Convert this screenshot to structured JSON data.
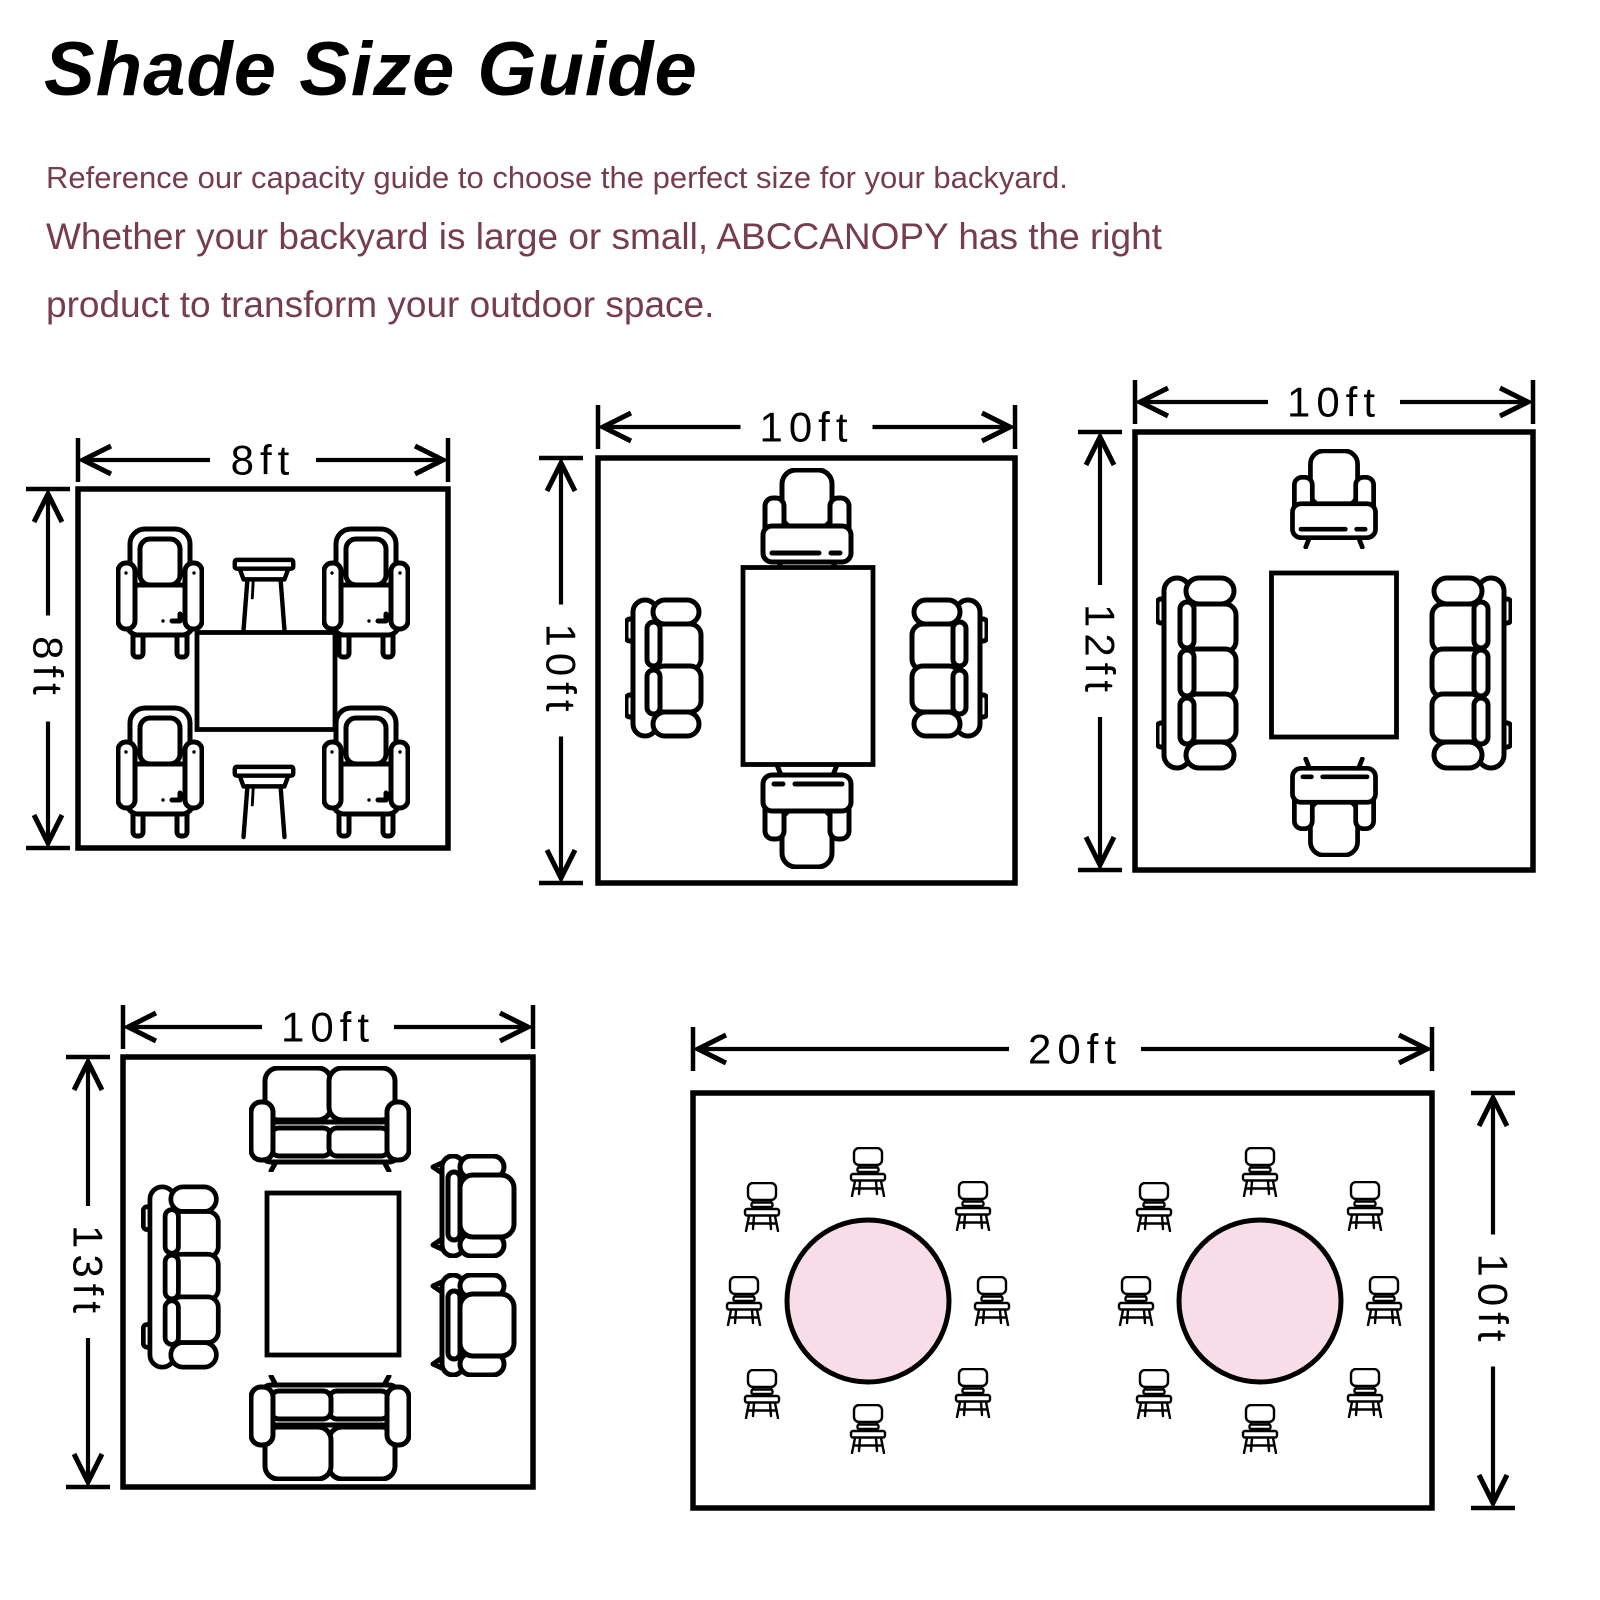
{
  "header": {
    "title": "Shade Size Guide",
    "intro": {
      "line1": "Reference our capacity guide to choose the perfect size for your backyard.",
      "line2": "Whether your backyard is large or small, ABCCANOPY has the right",
      "line3": "product to transform your outdoor space."
    }
  },
  "colors": {
    "line": "#000000",
    "accent_text": "#753C52",
    "table_fill": "#F8DCE8",
    "background": "#FFFFFF"
  },
  "diagrams": [
    {
      "name": "8x8",
      "box": {
        "x": 78,
        "y": 489,
        "w": 370,
        "h": 359
      },
      "h_dim": {
        "y": 460,
        "x1": 78,
        "x2": 448,
        "label": "8ft"
      },
      "v_dim": {
        "x": 48,
        "y1": 489,
        "y2": 848,
        "label": "8ft",
        "side": "left"
      },
      "furniture": [
        {
          "type": "armchair-front",
          "cx": 160,
          "cy": 593,
          "w": 88,
          "h": 140
        },
        {
          "type": "side-table",
          "cx": 264,
          "cy": 594,
          "w": 66,
          "h": 78
        },
        {
          "type": "armchair-front",
          "cx": 366,
          "cy": 593,
          "w": 88,
          "h": 140
        },
        {
          "type": "rect-table",
          "cx": 266,
          "cy": 681,
          "w": 138,
          "h": 97
        },
        {
          "type": "armchair-front",
          "cx": 160,
          "cy": 772,
          "w": 88,
          "h": 140
        },
        {
          "type": "side-table",
          "cx": 264,
          "cy": 801,
          "w": 66,
          "h": 78
        },
        {
          "type": "armchair-front",
          "cx": 366,
          "cy": 772,
          "w": 88,
          "h": 140
        }
      ]
    },
    {
      "name": "10x10",
      "box": {
        "x": 598,
        "y": 458,
        "w": 417,
        "h": 425
      },
      "h_dim": {
        "y": 427,
        "x1": 598,
        "x2": 1015,
        "label": "10ft"
      },
      "v_dim": {
        "x": 561,
        "y1": 458,
        "y2": 883,
        "label": "10ft",
        "side": "left"
      },
      "furniture": [
        {
          "type": "armchair2-front",
          "cx": 807,
          "cy": 521,
          "w": 96,
          "h": 106
        },
        {
          "type": "sofa2-top",
          "cx": 665,
          "cy": 668,
          "w": 80,
          "h": 142
        },
        {
          "type": "rect-table",
          "cx": 808,
          "cy": 666,
          "w": 130,
          "h": 197
        },
        {
          "type": "sofa2-top",
          "cx": 948,
          "cy": 668,
          "w": 80,
          "h": 142,
          "flip": true
        },
        {
          "type": "armchair2-front",
          "cx": 807,
          "cy": 816,
          "w": 96,
          "h": 106,
          "rot": 180
        }
      ]
    },
    {
      "name": "10x12",
      "box": {
        "x": 1135,
        "y": 432,
        "w": 398,
        "h": 438
      },
      "h_dim": {
        "y": 402,
        "x1": 1135,
        "x2": 1533,
        "label": "10ft"
      },
      "v_dim": {
        "x": 1100,
        "y1": 432,
        "y2": 870,
        "label": "12ft",
        "side": "left"
      },
      "furniture": [
        {
          "type": "armchair2-front",
          "cx": 1334,
          "cy": 499,
          "w": 112,
          "h": 100
        },
        {
          "type": "sofa3-top",
          "cx": 1202,
          "cy": 673,
          "w": 92,
          "h": 196
        },
        {
          "type": "rect-table",
          "cx": 1334,
          "cy": 655,
          "w": 125,
          "h": 164
        },
        {
          "type": "sofa3-top",
          "cx": 1466,
          "cy": 673,
          "w": 92,
          "h": 196,
          "flip": true
        },
        {
          "type": "armchair2-front",
          "cx": 1334,
          "cy": 807,
          "w": 112,
          "h": 100,
          "rot": 180
        }
      ]
    },
    {
      "name": "10x13",
      "box": {
        "x": 123,
        "y": 1057,
        "w": 410,
        "h": 430
      },
      "h_dim": {
        "y": 1027,
        "x1": 123,
        "x2": 533,
        "label": "10ft"
      },
      "v_dim": {
        "x": 88,
        "y1": 1057,
        "y2": 1487,
        "label": "13ft",
        "side": "left"
      },
      "furniture": [
        {
          "type": "loveseat-front",
          "cx": 330,
          "cy": 1119,
          "w": 162,
          "h": 106
        },
        {
          "type": "sofa3-top",
          "cx": 186,
          "cy": 1277,
          "w": 90,
          "h": 186
        },
        {
          "type": "rect-table",
          "cx": 333,
          "cy": 1274,
          "w": 132,
          "h": 162
        },
        {
          "type": "armchair-top",
          "cx": 474,
          "cy": 1206,
          "w": 88,
          "h": 104
        },
        {
          "type": "armchair-top",
          "cx": 474,
          "cy": 1325,
          "w": 88,
          "h": 104
        },
        {
          "type": "loveseat-front",
          "cx": 330,
          "cy": 1428,
          "w": 162,
          "h": 106,
          "rot": 180
        }
      ]
    },
    {
      "name": "20x10",
      "box": {
        "x": 693,
        "y": 1093,
        "w": 739,
        "h": 415
      },
      "h_dim": {
        "y": 1049,
        "x1": 693,
        "x2": 1432,
        "label": "20ft",
        "label_x": 1075
      },
      "v_dim": {
        "x": 1493,
        "y1": 1093,
        "y2": 1508,
        "label": "10ft",
        "side": "right"
      },
      "furniture": [
        {
          "type": "round-table",
          "cx": 868,
          "cy": 1301,
          "w": 162,
          "h": 162
        },
        {
          "type": "round-table",
          "cx": 1260,
          "cy": 1301,
          "w": 162,
          "h": 162
        },
        {
          "type": "chair",
          "cx": 868,
          "cy": 1172,
          "w": 38,
          "h": 50
        },
        {
          "type": "chair",
          "cx": 762,
          "cy": 1207,
          "w": 38,
          "h": 50
        },
        {
          "type": "chair",
          "cx": 973,
          "cy": 1206,
          "w": 38,
          "h": 50
        },
        {
          "type": "chair",
          "cx": 744,
          "cy": 1301,
          "w": 38,
          "h": 50
        },
        {
          "type": "chair",
          "cx": 992,
          "cy": 1301,
          "w": 38,
          "h": 50
        },
        {
          "type": "chair",
          "cx": 762,
          "cy": 1394,
          "w": 38,
          "h": 50
        },
        {
          "type": "chair",
          "cx": 973,
          "cy": 1393,
          "w": 38,
          "h": 50
        },
        {
          "type": "chair",
          "cx": 868,
          "cy": 1429,
          "w": 38,
          "h": 50
        },
        {
          "type": "chair",
          "cx": 1260,
          "cy": 1172,
          "w": 38,
          "h": 50
        },
        {
          "type": "chair",
          "cx": 1154,
          "cy": 1207,
          "w": 38,
          "h": 50
        },
        {
          "type": "chair",
          "cx": 1365,
          "cy": 1206,
          "w": 38,
          "h": 50
        },
        {
          "type": "chair",
          "cx": 1136,
          "cy": 1301,
          "w": 38,
          "h": 50
        },
        {
          "type": "chair",
          "cx": 1384,
          "cy": 1301,
          "w": 38,
          "h": 50
        },
        {
          "type": "chair",
          "cx": 1154,
          "cy": 1394,
          "w": 38,
          "h": 50
        },
        {
          "type": "chair",
          "cx": 1365,
          "cy": 1393,
          "w": 38,
          "h": 50
        },
        {
          "type": "chair",
          "cx": 1260,
          "cy": 1429,
          "w": 38,
          "h": 50
        }
      ]
    }
  ]
}
